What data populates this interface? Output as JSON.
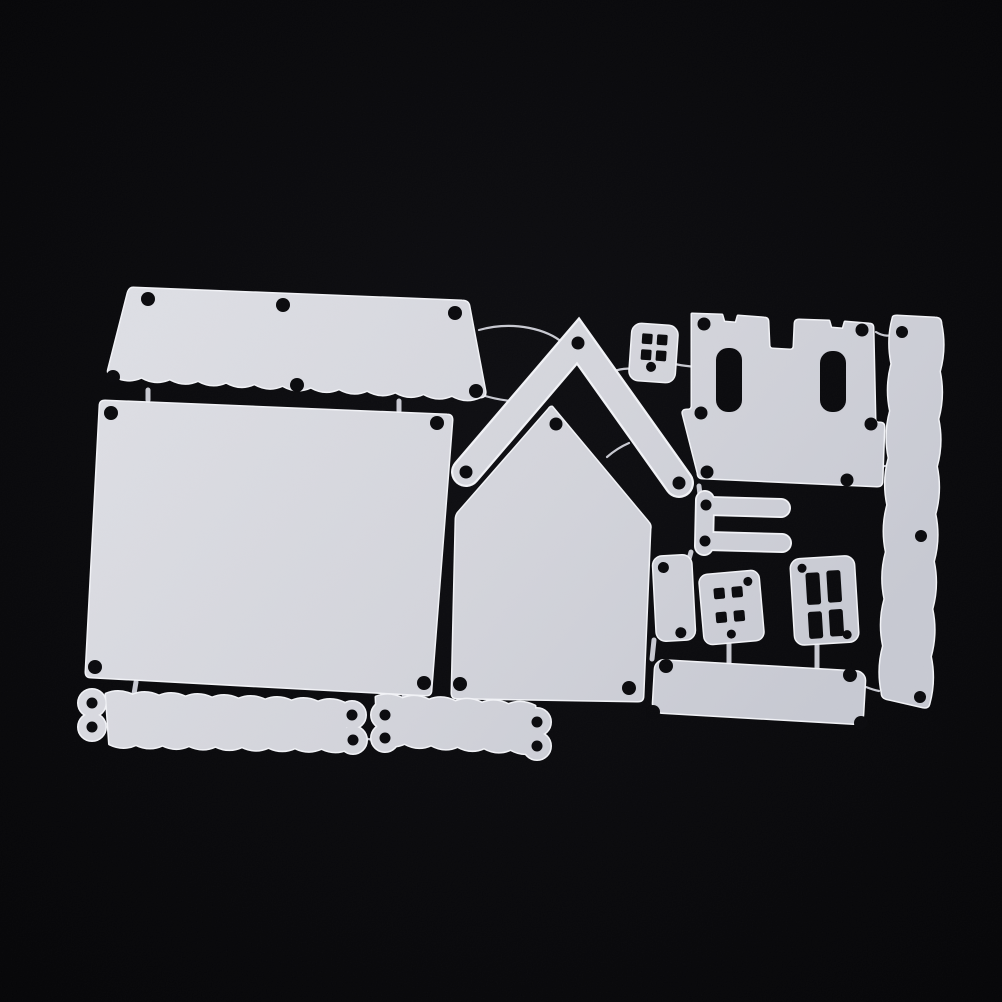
{
  "scene": {
    "type": "product-photo",
    "subject": "metal-cutting-die-set-house-theme",
    "background": "black",
    "piece_count": 14,
    "connector_count": 19
  },
  "colors": {
    "background": "#030305",
    "background_glow": "#0c0c10",
    "die_light": "#dcdde3",
    "die_mid": "#d2d3da",
    "die_dark": "#c6c8d1",
    "die_edge": "#f1f2f6",
    "hole": "#08080b",
    "connector": "#c7c8d0"
  },
  "pieces": [
    {
      "name": "scalloped-roof-panel-die",
      "shape": "slanted panel, scalloped bottom edge",
      "hole_count": 6
    },
    {
      "name": "wall-panel-die",
      "shape": "large rectangle",
      "hole_count": 4
    },
    {
      "name": "house-front-die",
      "shape": "pentagon with peaked top",
      "hole_count": 3
    },
    {
      "name": "roof-chevron-die",
      "shape": "inverted-V strip",
      "hole_count": 3
    },
    {
      "name": "dice-window-die",
      "shape": "small rounded square, 4 square holes + 1 round",
      "hole_count": 5
    },
    {
      "name": "castle-battlement-die",
      "shape": "two crenellated towers on trapezoid base, 2 slots",
      "hole_count": 6
    },
    {
      "name": "wavy-border-strip-die",
      "shape": "long vertical strip with wavy edges",
      "hole_count": 3
    },
    {
      "name": "door-bracket-die",
      "shape": "two-prong fork",
      "hole_count": 2
    },
    {
      "name": "small-door-panel-die",
      "shape": "small rounded rectangle",
      "hole_count": 2
    },
    {
      "name": "four-pane-window-die",
      "shape": "square with 2x2 small panes",
      "hole_count": 2
    },
    {
      "name": "tall-pane-window-die",
      "shape": "rectangle with 2x2 tall panes",
      "hole_count": 2
    },
    {
      "name": "sign-plate-die",
      "shape": "wide rounded rectangle",
      "hole_count": 4
    },
    {
      "name": "scallop-border-strip-long-die",
      "shape": "scalloped strip, double-lobe ends",
      "hole_count": 4
    },
    {
      "name": "scallop-border-strip-short-die",
      "shape": "scalloped strip, double-lobe ends",
      "hole_count": 4
    }
  ]
}
